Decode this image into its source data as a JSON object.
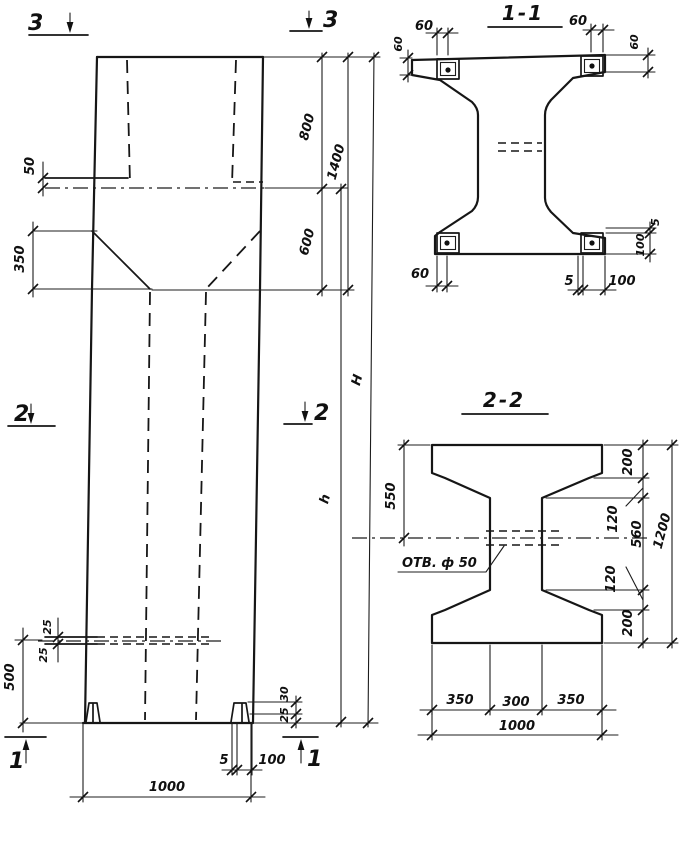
{
  "drawing": {
    "elevation": {
      "marks": {
        "top_left": "3",
        "top_right": "3",
        "mid_left": "2",
        "mid_right": "2",
        "bottom_left": "1",
        "bottom_right": "1"
      },
      "dims": {
        "ledge_offset": "50",
        "taper_height": "350",
        "top_segment": "800",
        "top_total": "1400",
        "neck_segment": "600",
        "total_height": "H",
        "shaft_height": "h",
        "hole_upper": "25",
        "hole_lower": "25",
        "base_height": "500",
        "lug_upper": "30",
        "lug_lower": "25",
        "lug_thickness": "5",
        "lug_width": "100",
        "base_width": "1000"
      }
    },
    "section_1_1": {
      "title": "1-1",
      "dims": {
        "plate_offset_top_left": "60",
        "plate_side_left": "60",
        "plate_offset_top_right": "60",
        "plate_side_right": "60",
        "plate_offset_bottom": "60",
        "plate_gap_bottom": "5",
        "plate_width_bottom": "100",
        "plate_gap_right": "5",
        "plate_width_right": "100"
      }
    },
    "section_2_2": {
      "title": "2-2",
      "hole_label": "ОТВ. ф 50",
      "dims": {
        "flange_to_hole": "550",
        "flange_top": "200",
        "fillet_top": "120",
        "web_clear": "560",
        "fillet_bottom": "120",
        "flange_bottom": "200",
        "section_height": "1200",
        "flange_left": "350",
        "web_width": "300",
        "flange_right": "350",
        "section_width": "1000"
      }
    }
  }
}
